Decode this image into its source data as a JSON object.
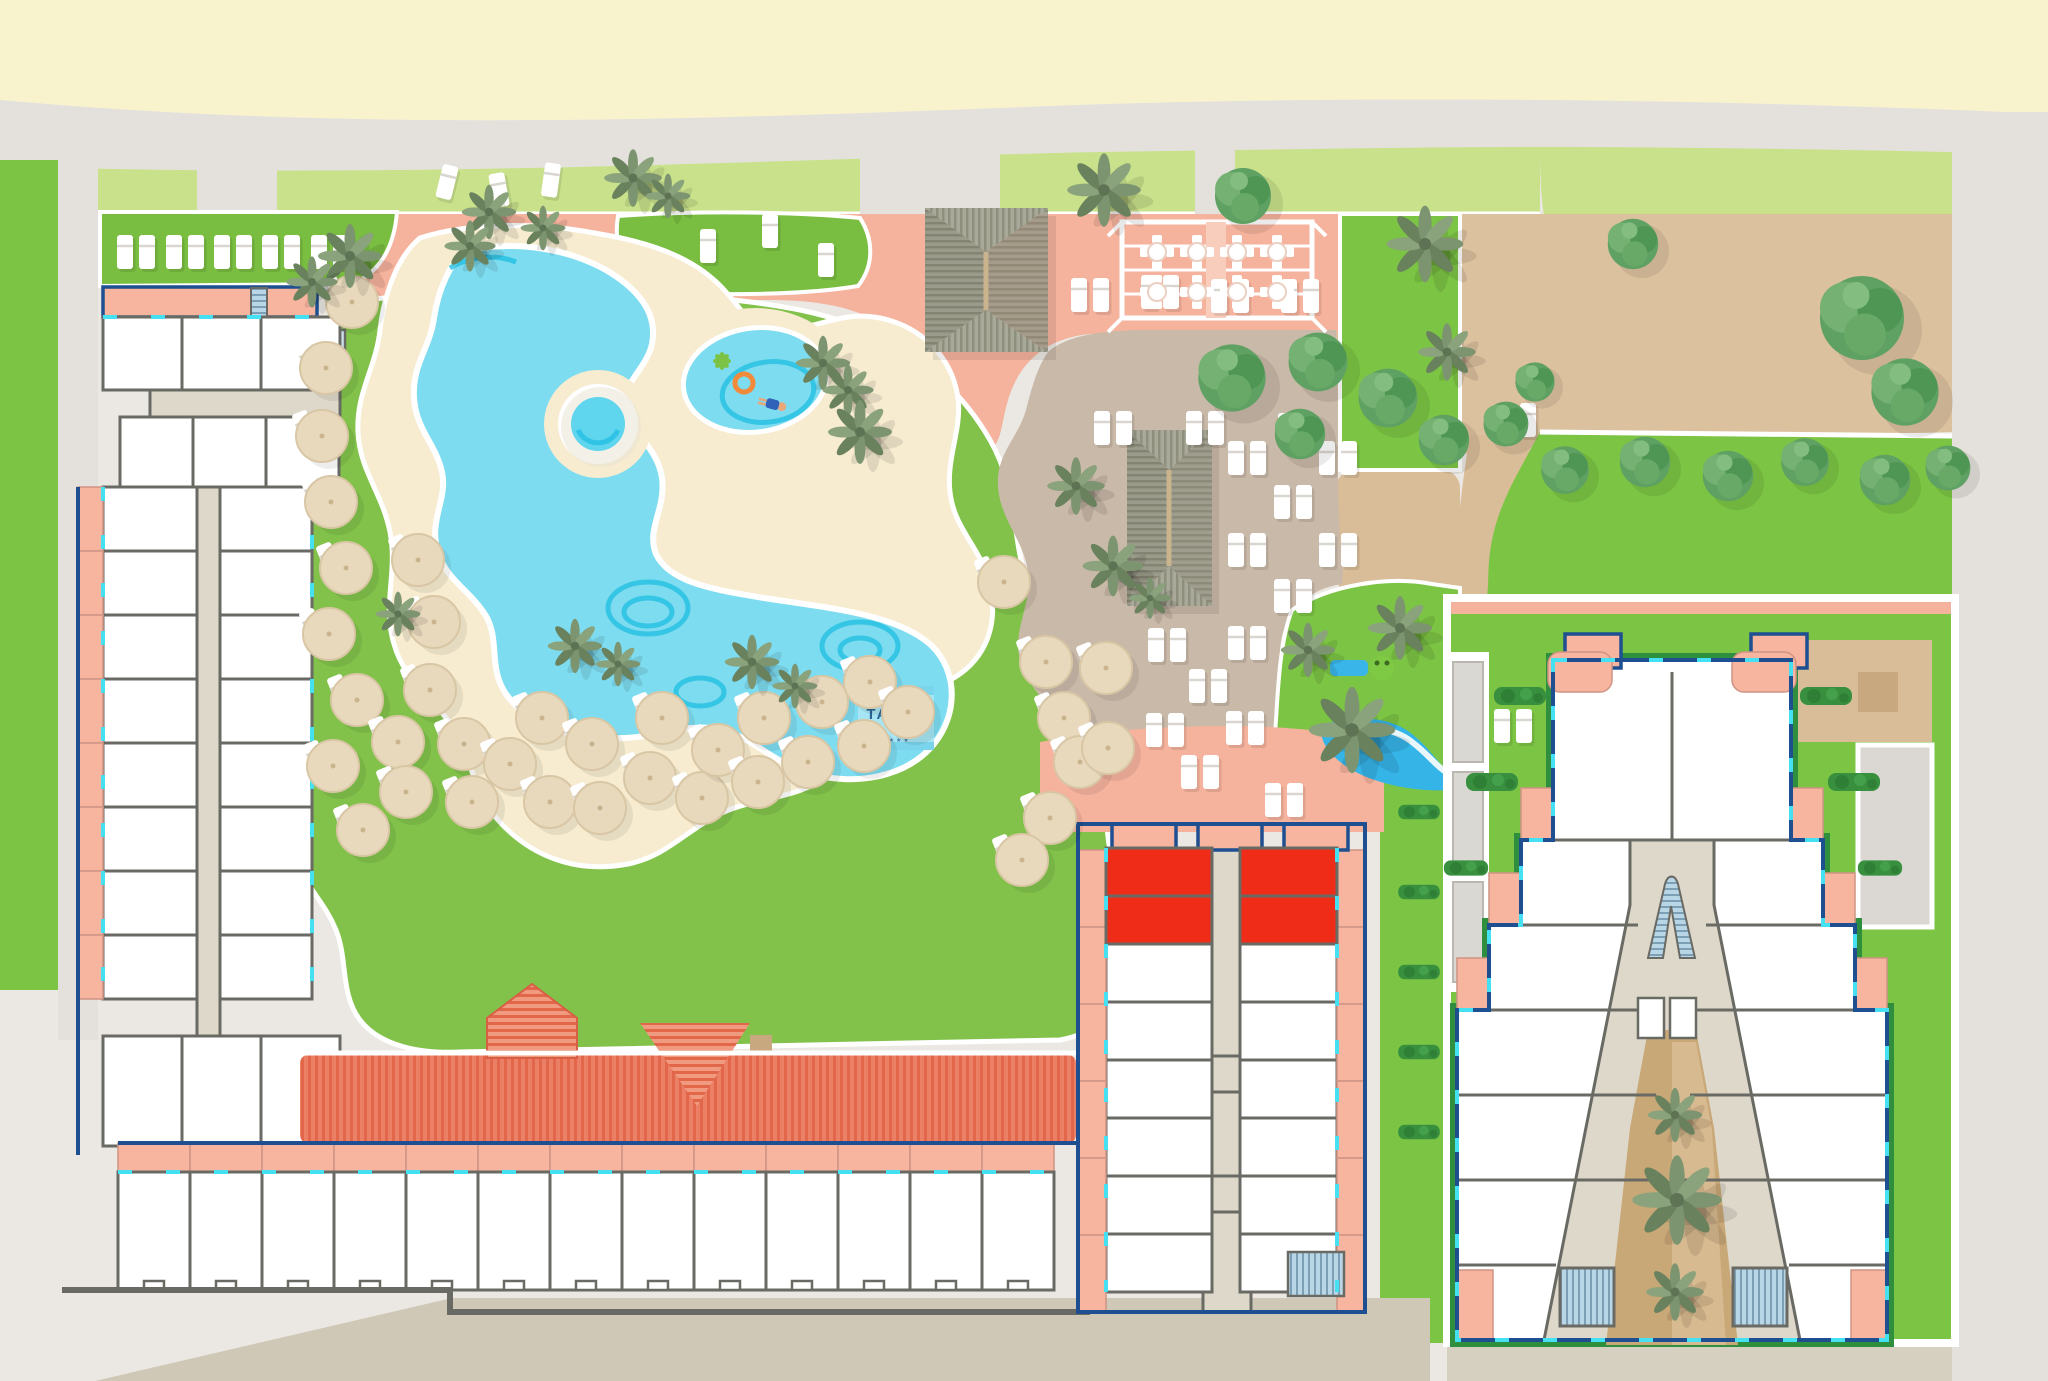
{
  "app": {
    "title": "Tahiti Playa resort site map"
  },
  "logo": {
    "title": "TAHITI",
    "subtitle": "PLAYA",
    "stars": "★★★★"
  },
  "palette": {
    "beach_sand": "#f9f3cd",
    "promenade_gray": "#e4e1dc",
    "ground_gray": "#ebe8e3",
    "grass_light": "#c8e18a",
    "grass_green": "#82c24b",
    "grass_bright": "#7cc544",
    "lawn_dark": "#79bd41",
    "pool_blue": "#7edcf0",
    "pool_deep_blue": "#23bfe2",
    "deck_sand": "#f7ecd0",
    "deck_salmon": "#f5b29c",
    "deck_taupe": "#c9b9a8",
    "dirt_tan": "#dcc19e",
    "courtyard_brown": "#c9a878",
    "room_white": "#ffffff",
    "wall_gray": "#6a6a64",
    "outline_blue": "#1d4f91",
    "window_cyan": "#45e0f2",
    "highlight_red": "#ee2c17",
    "roof_red": "#ec8066",
    "thatch_gray": "#9b9b8b",
    "stair_blue": "#b9d6e6",
    "logo_box_blue": "#a6e5f3",
    "logo_text_blue": "#2a6596"
  },
  "map": {
    "umbrellas": [
      [
        352,
        302
      ],
      [
        326,
        368
      ],
      [
        322,
        436
      ],
      [
        331,
        502
      ],
      [
        346,
        568
      ],
      [
        329,
        634
      ],
      [
        357,
        700
      ],
      [
        333,
        766
      ],
      [
        363,
        830
      ],
      [
        398,
        742
      ],
      [
        406,
        792
      ],
      [
        418,
        560
      ],
      [
        434,
        622
      ],
      [
        430,
        690
      ],
      [
        464,
        744
      ],
      [
        472,
        802
      ],
      [
        510,
        764
      ],
      [
        542,
        718
      ],
      [
        550,
        802
      ],
      [
        592,
        744
      ],
      [
        600,
        808
      ],
      [
        650,
        778
      ],
      [
        662,
        718
      ],
      [
        702,
        798
      ],
      [
        718,
        750
      ],
      [
        758,
        782
      ],
      [
        764,
        718
      ],
      [
        808,
        762
      ],
      [
        822,
        702
      ],
      [
        864,
        746
      ],
      [
        870,
        682
      ],
      [
        908,
        712
      ],
      [
        1004,
        582
      ],
      [
        1046,
        662
      ],
      [
        1064,
        718
      ],
      [
        1050,
        818
      ],
      [
        1022,
        860
      ],
      [
        1080,
        762
      ],
      [
        1106,
        668
      ],
      [
        1108,
        748
      ]
    ],
    "loungerPairs": [
      [
        136,
        252
      ],
      [
        185,
        252
      ],
      [
        233,
        252
      ],
      [
        281,
        252
      ],
      [
        330,
        252
      ],
      [
        1090,
        295
      ],
      [
        1160,
        292
      ],
      [
        1230,
        296
      ],
      [
        1300,
        296
      ],
      [
        1113,
        428
      ],
      [
        1205,
        428
      ],
      [
        1297,
        430
      ],
      [
        1247,
        458
      ],
      [
        1338,
        458
      ],
      [
        1293,
        502
      ],
      [
        1247,
        550
      ],
      [
        1338,
        550
      ],
      [
        1293,
        596
      ],
      [
        1167,
        645
      ],
      [
        1247,
        643
      ],
      [
        1208,
        686
      ],
      [
        1165,
        730
      ],
      [
        1245,
        728
      ],
      [
        1200,
        772
      ],
      [
        1284,
        800
      ],
      [
        1513,
        726
      ],
      [
        1517,
        420
      ]
    ],
    "loungerSingles": [
      [
        447,
        182,
        14
      ],
      [
        499,
        190,
        -10
      ],
      [
        551,
        180,
        8
      ],
      [
        708,
        246,
        0
      ],
      [
        770,
        231,
        0
      ],
      [
        826,
        260,
        0
      ]
    ],
    "palms": [
      [
        350,
        256,
        1.0
      ],
      [
        312,
        282,
        0.8
      ],
      [
        489,
        212,
        0.85
      ],
      [
        543,
        228,
        0.7
      ],
      [
        633,
        178,
        0.9
      ],
      [
        668,
        196,
        0.7
      ],
      [
        470,
        246,
        0.8
      ],
      [
        823,
        363,
        0.85
      ],
      [
        848,
        390,
        0.8
      ],
      [
        860,
        432,
        1.0
      ],
      [
        575,
        646,
        0.85
      ],
      [
        618,
        664,
        0.7
      ],
      [
        752,
        662,
        0.85
      ],
      [
        795,
        686,
        0.7
      ],
      [
        398,
        614,
        0.7
      ],
      [
        1113,
        566,
        0.95
      ],
      [
        1150,
        598,
        0.65
      ],
      [
        1352,
        730,
        1.35
      ],
      [
        1400,
        628,
        1.0
      ],
      [
        1308,
        650,
        0.85
      ],
      [
        1425,
        244,
        1.2
      ],
      [
        1447,
        352,
        0.9
      ],
      [
        1104,
        190,
        1.15
      ],
      [
        1076,
        486,
        0.9
      ],
      [
        1675,
        1115,
        0.85
      ],
      [
        1677,
        1200,
        1.4
      ],
      [
        1675,
        1292,
        0.9
      ]
    ],
    "trees": [
      [
        1243,
        196,
        1.0
      ],
      [
        1232,
        378,
        1.2
      ],
      [
        1318,
        362,
        1.05
      ],
      [
        1300,
        434,
        0.9
      ],
      [
        1388,
        398,
        1.05
      ],
      [
        1444,
        440,
        0.9
      ],
      [
        1506,
        424,
        0.8
      ],
      [
        1535,
        382,
        0.7
      ],
      [
        1633,
        244,
        0.9
      ],
      [
        1862,
        318,
        1.5
      ],
      [
        1905,
        392,
        1.2
      ],
      [
        1565,
        470,
        0.85
      ],
      [
        1645,
        462,
        0.9
      ],
      [
        1728,
        476,
        0.9
      ],
      [
        1805,
        462,
        0.85
      ],
      [
        1885,
        480,
        0.9
      ],
      [
        1948,
        468,
        0.8
      ]
    ],
    "hedges": [
      [
        1520,
        696,
        1
      ],
      [
        1826,
        696,
        1
      ],
      [
        1492,
        782,
        1
      ],
      [
        1854,
        782,
        1
      ],
      [
        1466,
        868,
        0.85
      ],
      [
        1880,
        868,
        0.85
      ],
      [
        1419,
        812,
        0.8
      ],
      [
        1419,
        892,
        0.8
      ],
      [
        1419,
        972,
        0.8
      ],
      [
        1419,
        1052,
        0.8
      ],
      [
        1419,
        1132,
        0.8
      ]
    ],
    "pergolaTables": [
      [
        1157,
        252
      ],
      [
        1197,
        252
      ],
      [
        1237,
        252
      ],
      [
        1277,
        252
      ],
      [
        1157,
        292
      ],
      [
        1197,
        292
      ],
      [
        1237,
        292
      ],
      [
        1277,
        292
      ]
    ],
    "roomGrids": [
      {
        "name": "south-wing-balconies",
        "x": 118,
        "y": 1143,
        "w": 72,
        "h": 29,
        "count": 13,
        "cls": "balc",
        "click": false
      },
      {
        "name": "south-wing-rooms",
        "x": 118,
        "y": 1172,
        "w": 72,
        "h": 118,
        "count": 13,
        "cls": "room",
        "notch": true,
        "click": true
      },
      {
        "name": "west-wing-upper-rooms",
        "x": 103,
        "y": 317,
        "w": 79,
        "h": 73,
        "count": 3,
        "cls": "room",
        "click": true
      },
      {
        "name": "west-wing-middle-rooms",
        "x": 120,
        "y": 417,
        "w": 73,
        "h": 70,
        "count": 3,
        "cls": "room",
        "click": true
      },
      {
        "name": "west-wing-left-rooms",
        "x": 103,
        "y": 487,
        "w": 94,
        "h": 64,
        "count": 8,
        "vert": true,
        "cls": "room",
        "click": true
      },
      {
        "name": "west-wing-right-rooms",
        "x": 220,
        "y": 487,
        "w": 92,
        "h": 64,
        "count": 8,
        "vert": true,
        "cls": "room",
        "click": true
      },
      {
        "name": "west-wing-balconies",
        "x": 78,
        "y": 487,
        "w": 25,
        "h": 64,
        "count": 8,
        "vert": true,
        "cls": "balc",
        "click": false
      },
      {
        "name": "west-wing-lower-rooms",
        "x": 103,
        "y": 1036,
        "w": 79,
        "h": 110,
        "count": 3,
        "cls": "room",
        "click": true
      },
      {
        "name": "central-building-left-rooms",
        "x": 1106,
        "y": 944,
        "w": 106,
        "h": 58,
        "count": 6,
        "vert": true,
        "cls": "room",
        "click": true
      },
      {
        "name": "central-building-right-rooms",
        "x": 1240,
        "y": 944,
        "w": 97,
        "h": 58,
        "count": 6,
        "vert": true,
        "cls": "room",
        "click": true
      },
      {
        "name": "central-building-left-balconies",
        "x": 1078,
        "y": 850,
        "w": 28,
        "h": 77,
        "count": 6,
        "vert": true,
        "cls": "balc",
        "click": false
      },
      {
        "name": "central-building-right-balconies",
        "x": 1337,
        "y": 850,
        "w": 28,
        "h": 77,
        "count": 6,
        "vert": true,
        "cls": "balc",
        "click": false
      },
      {
        "name": "central-building-top-balconies",
        "x": 1112,
        "y": 824,
        "w": 64,
        "h": 26,
        "count": 3,
        "gap": 22,
        "cls": "balc-b",
        "click": false
      }
    ],
    "highlightedRooms": [
      [
        1106,
        848,
        106,
        48
      ],
      [
        1240,
        848,
        97,
        48
      ],
      [
        1106,
        896,
        106,
        48
      ],
      [
        1240,
        896,
        97,
        48
      ]
    ]
  }
}
